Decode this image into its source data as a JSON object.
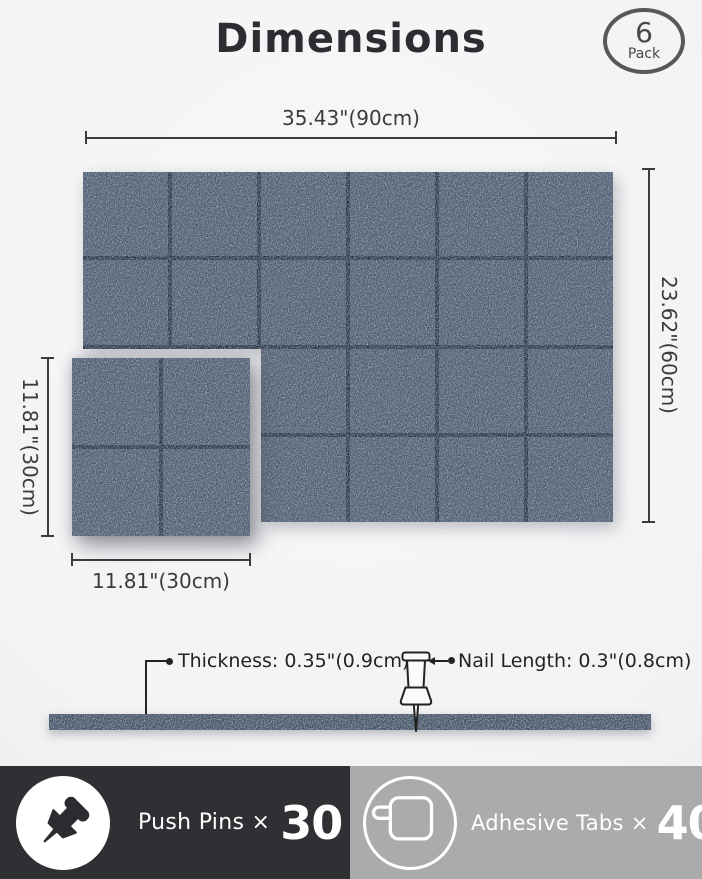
{
  "page": {
    "title": "Dimensions"
  },
  "badge": {
    "count": "6",
    "label": "Pack"
  },
  "dimensions": {
    "total_width": "35.43\"(90cm)",
    "total_height": "23.62\"(60cm)",
    "panel_width": "11.81\"(30cm)",
    "panel_height": "11.81\"(30cm)",
    "thickness": "Thickness: 0.35\"(0.9cm)",
    "nail_length": "Nail Length: 0.3\"(0.8cm)"
  },
  "panel": {
    "pack_count": 6,
    "arrangement_columns": 3,
    "arrangement_rows": 2,
    "tiles_per_panel": 4,
    "felt_color": "#4c5b6e",
    "groove_color": "#202b38",
    "strip_color": "#3f4d5f"
  },
  "included": {
    "push_pins_label": "Push Pins ×",
    "push_pins_count": "30",
    "adhesive_tabs_label": "Adhesive Tabs ×",
    "adhesive_tabs_count": "40"
  },
  "colors": {
    "bar_dark": "#303034",
    "bar_gray": "#ababab",
    "dimension_text": "#3b3b3d",
    "title_text": "#2d2d31"
  }
}
